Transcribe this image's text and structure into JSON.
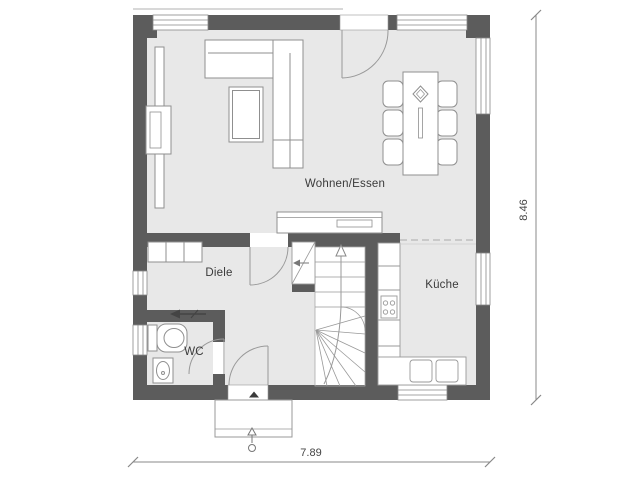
{
  "drawing": {
    "type": "floor-plan",
    "rooms": {
      "living": {
        "label": "Wohnen/Essen"
      },
      "hall": {
        "label": "Diele"
      },
      "wc": {
        "label": "WC"
      },
      "kitchen": {
        "label": "Küche"
      }
    },
    "dimensions": {
      "total_width": "7.89",
      "total_height": "8.46"
    },
    "colors": {
      "wall": "#5c5c5c",
      "floor": "#e8e8e8",
      "furniture_line": "#8f8f8f",
      "stair_line": "#999999",
      "label_text": "#3a3a3a",
      "dimension_line": "#888888",
      "background": "#ffffff"
    }
  }
}
